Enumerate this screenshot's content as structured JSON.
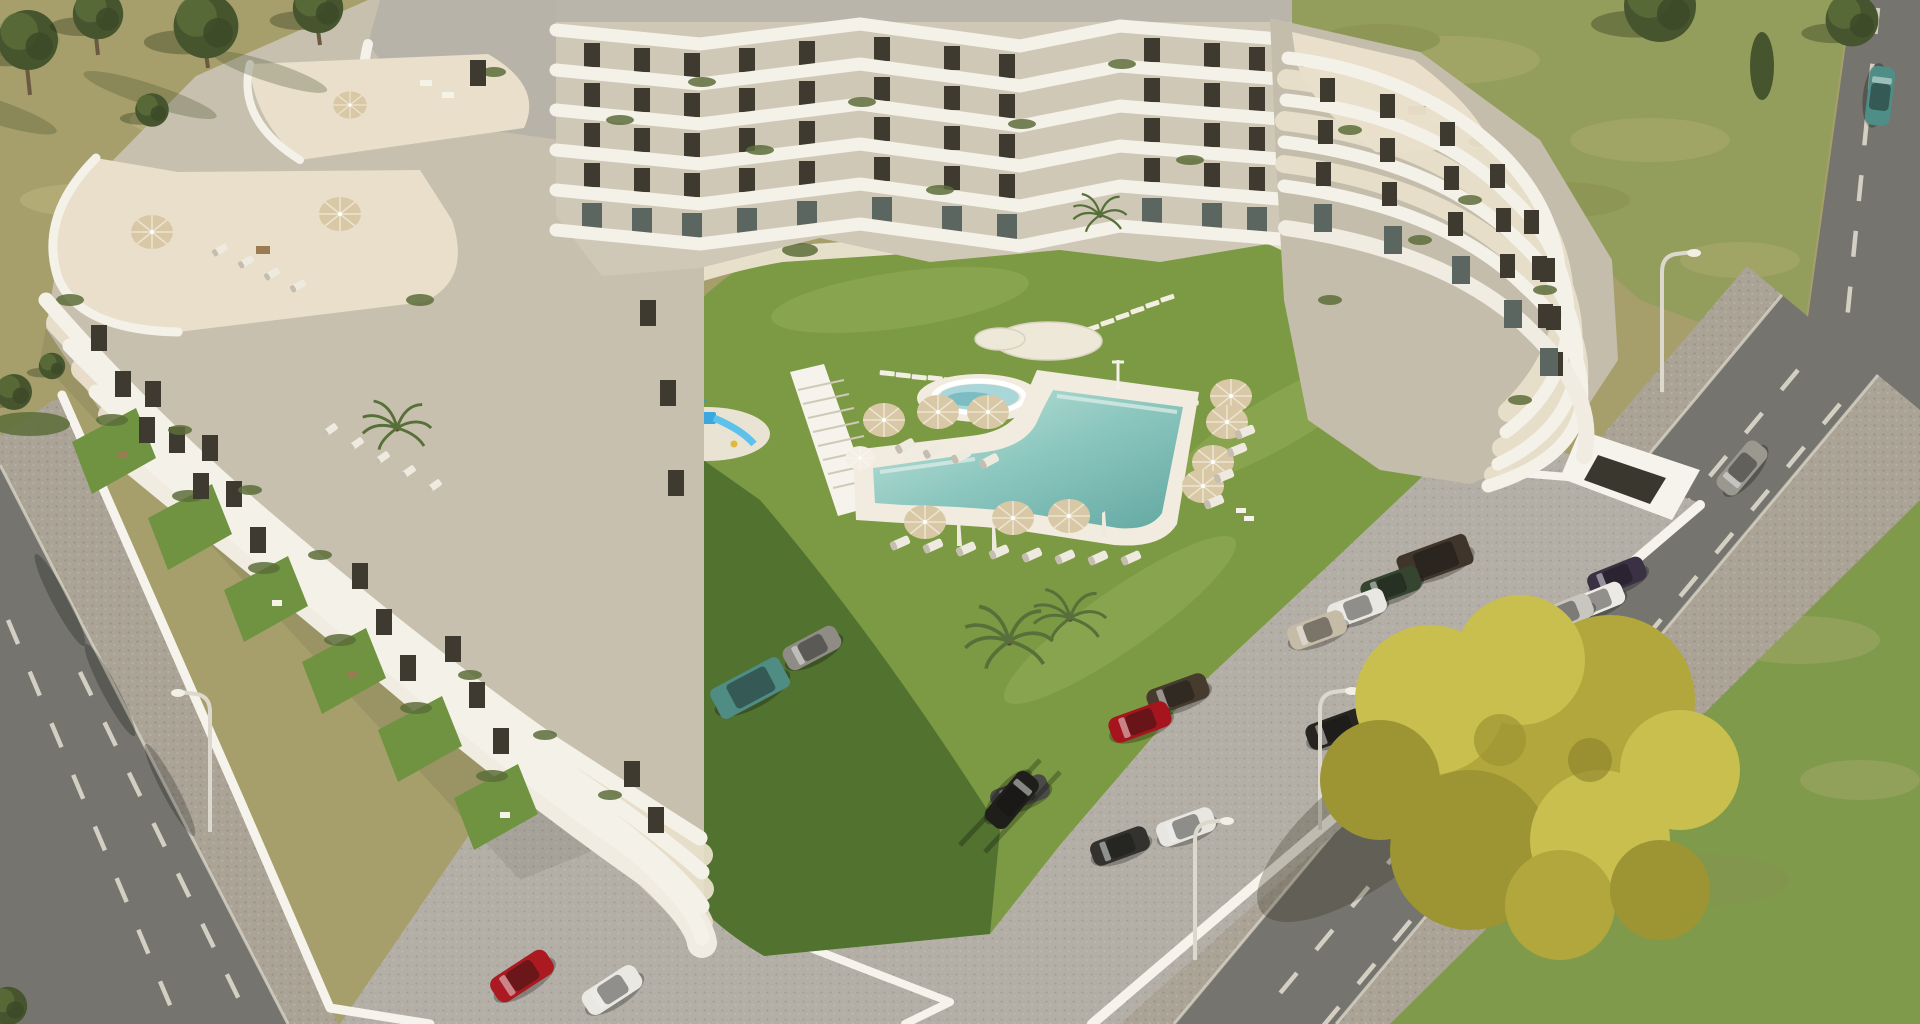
{
  "meta": {
    "description": "Aerial 3D architectural render of a white stepped terraced apartment complex with cascading balconies around a landscaped courtyard: L-shaped turquoise pool, circular spa, tan sun umbrellas with loungers, blue playground, green lawn, cobbled parking lot with cars, two diagonal roads with dashed lane markings, dry scrub fields and a yellow autumn tree.",
    "scene_type": "architectural aerial render",
    "canvas": "1920x1024",
    "visible_text": "none"
  },
  "palette": {
    "dry": "#a69f6b",
    "dryL": "#bdb47e",
    "dryD": "#89904f",
    "fgreen": "#939d5c",
    "fgreenL": "#adac6e",
    "grassBR": "#7f9a4b",
    "lawn": "#7c9a43",
    "lawnShadow": "#4c6c2d",
    "lawnG": "#6f9340",
    "poolDeck": "#f1ecdf",
    "spa": "#a9d6d8",
    "spaD": "#7dbcc2",
    "poolEdge": "#c6e7dd",
    "poolMid": "#8cc7bf",
    "poolDeep": "#63a8a2",
    "white": "#f4f1e9",
    "terr": "#e9dfca",
    "roof": "#b7b3a9",
    "wallA": "#d0c8b6",
    "wallB": "#c8c0ae",
    "wallB2": "#c5bdab",
    "win": "#3e3a30",
    "winG": "#5c6660",
    "road": "#75746e",
    "roadD": "#5e5d58",
    "cobble": "#aaa396",
    "parking": "#b3afa6",
    "curb": "#d8d3c6",
    "dash": "#ded9cc",
    "wallWhite": "#f6f3ec",
    "umbTan": "#d8c8a5",
    "umbWhite": "#f3efe6",
    "lng": "#efeadf",
    "blue": "#3ba7de",
    "blueL": "#5ec1ea",
    "treeDark": "#46552e",
    "treeMid": "#5c6d3a",
    "trunk": "#6b5a41",
    "yt1": "#b2a73d",
    "yt2": "#c9bf4e",
    "yt3": "#9d9433",
    "shadow": "#2e2a18"
  },
  "scene": {
    "building": {
      "style": "white curved stacked terrace bands over beige walls",
      "wings": [
        "left wing cascading to southwest with private gardens",
        "top wing zigzag balcony facade",
        "right wing rounded stepped terraces"
      ],
      "floors_visible": 7,
      "roof_terraces": 4
    },
    "courtyard": {
      "pool_shape": "L-shaped boomerang",
      "spa": "circular jacuzzi on round deck",
      "paved_circles": 2,
      "stepping_stone_paths": 2,
      "umbrellas_tan": 10,
      "umbrellas_white": 1,
      "closed_parasols": 3,
      "loungers_white": 22,
      "playground": "blue slide tower on sand pad",
      "palm_trees": 3
    },
    "parking": {
      "surface": "gray cobblestone",
      "occupied_spaces": 16,
      "garage_entrance": 1,
      "perimeter_wall": "white"
    },
    "roads": {
      "left_road": "two-lane with dashed markings",
      "right_road": "two-lane with dashed markings",
      "street_lamps": 4
    },
    "vegetation": {
      "yellow_tree": 1,
      "green_trees": 7,
      "fields": [
        "dry scrub top-left",
        "patchy green top-right",
        "lawn bottom-right"
      ]
    },
    "cars": [
      {
        "id": "suv-dark-brown",
        "hex": "#3f352a"
      },
      {
        "id": "sedan-dark-green",
        "hex": "#35452f"
      },
      {
        "id": "sedan-white",
        "hex": "#e9e7e1"
      },
      {
        "id": "sedan-beige",
        "hex": "#c6bba7"
      },
      {
        "id": "sedan-purple",
        "hex": "#3a3144"
      },
      {
        "id": "hatch-white",
        "hex": "#eceae4"
      },
      {
        "id": "sedan-silver",
        "hex": "#c9c6bf"
      },
      {
        "id": "sedan-brown",
        "hex": "#4a3c2e"
      },
      {
        "id": "sedan-black",
        "hex": "#26251f"
      },
      {
        "id": "sedan-dark-brown",
        "hex": "#463b2d"
      },
      {
        "id": "sports-red",
        "hex": "#a6151d"
      },
      {
        "id": "sedan-dark-gray",
        "hex": "#4a4a46"
      },
      {
        "id": "sedan-charcoal",
        "hex": "#33322e"
      },
      {
        "id": "sedan-white-2",
        "hex": "#e8e6e0"
      },
      {
        "id": "van-teal",
        "hex": "#4f8c84"
      },
      {
        "id": "sedan-gray",
        "hex": "#8f8c85"
      },
      {
        "id": "sports-red-2",
        "hex": "#ab1a20"
      },
      {
        "id": "sedan-white-3",
        "hex": "#eae8e2"
      },
      {
        "id": "road-car-black",
        "hex": "#1f1e1b"
      },
      {
        "id": "road-car-gray",
        "hex": "#9b988f"
      },
      {
        "id": "road-car-teal",
        "hex": "#4e8e86"
      }
    ]
  }
}
